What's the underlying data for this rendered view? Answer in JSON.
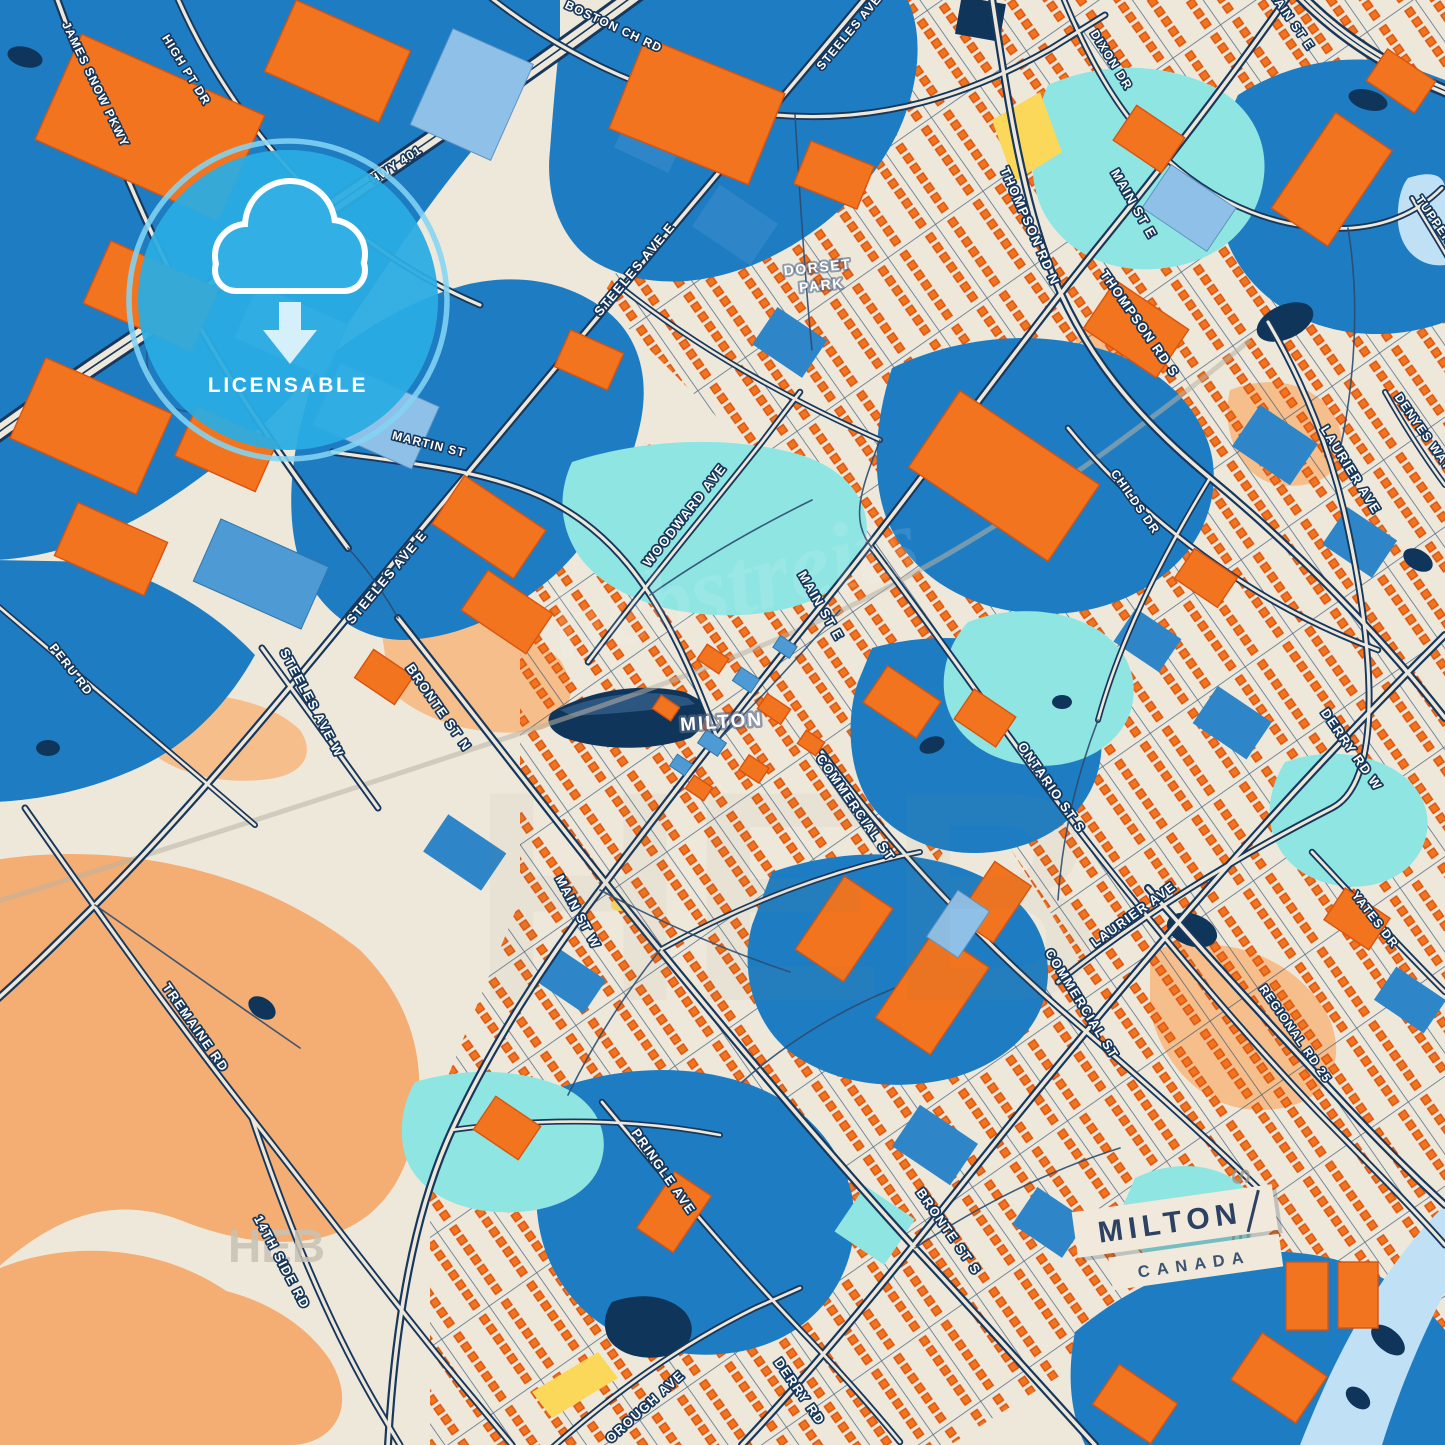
{
  "map": {
    "city_label": "MILTON",
    "park": {
      "line1": "DORSET",
      "line2": "PARK"
    },
    "streets": [
      {
        "name": "JAMES SNOW PKWY"
      },
      {
        "name": "HIGH PT DR"
      },
      {
        "name": "BOSTON CH RD"
      },
      {
        "name": "STEELES AVE"
      },
      {
        "name": "STEELES AVE E"
      },
      {
        "name": "STEELES AVE E"
      },
      {
        "name": "STEELES AVE W"
      },
      {
        "name": "MARTIN ST"
      },
      {
        "name": "DIXON DR"
      },
      {
        "name": "THOMPSON RD N"
      },
      {
        "name": "THOMPSON RD S"
      },
      {
        "name": "MAIN ST E"
      },
      {
        "name": "MAIN ST E"
      },
      {
        "name": "MAIN ST E"
      },
      {
        "name": "MAIN ST W"
      },
      {
        "name": "WOODWARD AVE"
      },
      {
        "name": "COMMERCIAL ST"
      },
      {
        "name": "COMMERCIAL ST"
      },
      {
        "name": "ONTARIO ST S"
      },
      {
        "name": "LAURIER AVE"
      },
      {
        "name": "LAURIER AVE"
      },
      {
        "name": "DERRY RD W"
      },
      {
        "name": "DERRY RD"
      },
      {
        "name": "YATES DR"
      },
      {
        "name": "REGIONAL RD 25"
      },
      {
        "name": "CHILDS DR"
      },
      {
        "name": "DENYES WAY"
      },
      {
        "name": "TUPPER DR"
      },
      {
        "name": "BRONTE ST N"
      },
      {
        "name": "BRONTE ST S"
      },
      {
        "name": "PRINGLE AVE"
      },
      {
        "name": "OROUGH AVE"
      },
      {
        "name": "PERU RD"
      },
      {
        "name": "TREMAINE RD"
      },
      {
        "name": "14TH SIDE RD"
      },
      {
        "name": "HWY 401"
      }
    ]
  },
  "badge": {
    "label": "LICENSABLE",
    "icon": "cloud-download-icon",
    "color": "#2AACE2",
    "ring_color": "#83D4F4"
  },
  "title_card": {
    "city": "MILTON",
    "country": "CANADA"
  },
  "watermark": {
    "big": "HEB",
    "medium": "HEB",
    "side": "STREIT",
    "script": "hebstreits"
  },
  "colors": {
    "background": "#EEE8DB",
    "district_blue": "#1E7DC2",
    "building_orange": "#F2741E",
    "navy": "#10355A",
    "park_cyan": "#8FE5E2",
    "field_peach": "#F4AD72",
    "pale_blue": "#BFE0F5",
    "yellow": "#FBD75A",
    "road_casing": "#17375C"
  }
}
